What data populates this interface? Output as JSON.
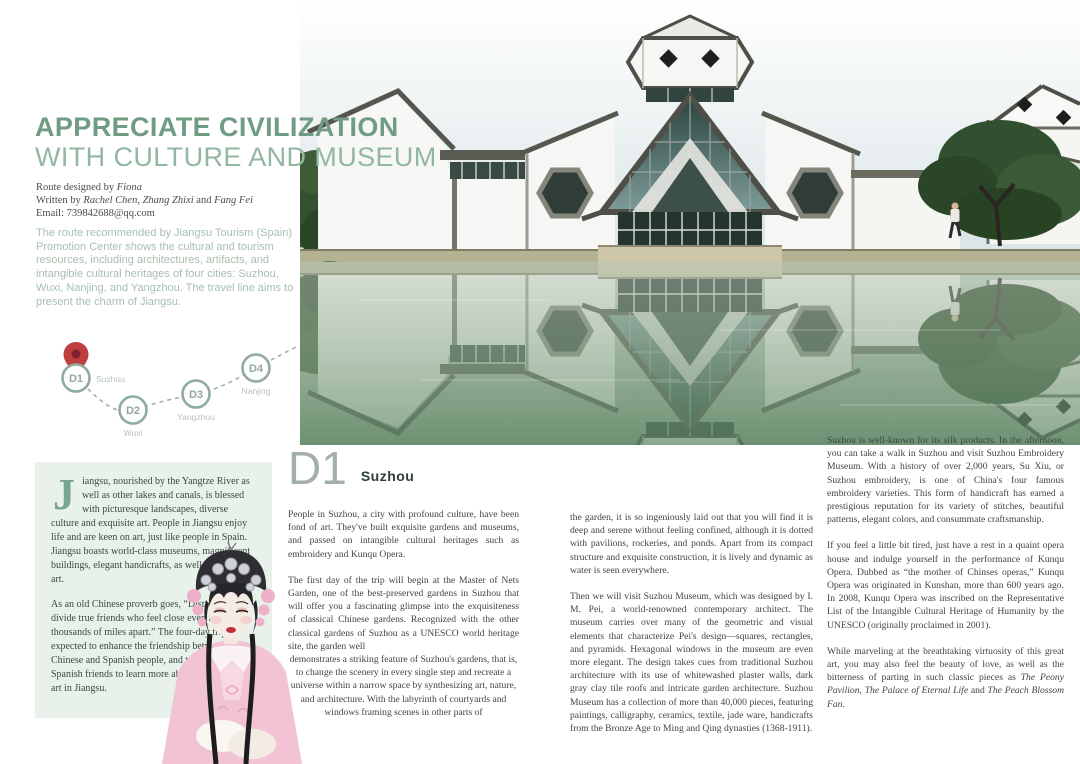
{
  "header": {
    "title_line1": "APPRECIATE CIVILIZATION",
    "title_line2": "WITH CULTURE AND MUSEUM",
    "credits": [
      {
        "pre": "Route designed by ",
        "name1": "Fiona",
        "mid": "",
        "name2": ""
      },
      {
        "pre": "Written by ",
        "name1": "Rachel Chen, Zhang Zhixi",
        "mid": " and ",
        "name2": "Fang Fei"
      },
      {
        "pre": "Email: 739842688@qq.com",
        "name1": "",
        "mid": "",
        "name2": ""
      }
    ]
  },
  "intro": {
    "text": "The route recommended by Jiangsu Tourism (Spain) Promotion Center shows the cultural and tourism resources, including architectures, artifacts, and intangible cultural heritages of four cities: Suzhou, Wuxi, Nanjing, and Yangzhou. The travel line aims to present the charm of Jiangsu."
  },
  "route_map": {
    "stops": [
      {
        "id": "D1",
        "city": "Suzhou"
      },
      {
        "id": "D2",
        "city": "Wuxi"
      },
      {
        "id": "D3",
        "city": "Yangzhou"
      },
      {
        "id": "D4",
        "city": "Nanjing"
      }
    ],
    "pin_icon": "red-location-pin",
    "accent_color": "#8fac9c",
    "pin_color": "#bf3e3e"
  },
  "sidebar_box": {
    "dropcap": "J",
    "p1_rest": "iangsu, nourished by the Yangtze River as well as other lakes and canals, is blessed with picturesque landscapes, diverse culture and exquisite art. People in Jiangsu enjoy life and are keen on art, just like people in Spain. Jiangsu boasts world-class museums, magnificent buildings, elegant handicrafts, as well as ingenious art.",
    "p2": "As an old Chinese proverb goes, “Distance cannot divide true friends who feel close even if they are thousands of miles apart.” The four-day trip is expected to enhance the friendship between the Chinese and Spanish people, and to help our Spanish friends to learn more about the culture and art in Jiangsu."
  },
  "day_section": {
    "day": "D1",
    "city": "Suzhou"
  },
  "columns": {
    "col1": {
      "p1": "People in Suzhou, a city with profound culture, have been fond of art. They've built exquisite gardens and museums, and passed on intangible cultural heritages such as embroidery and Kunqu Opera.",
      "p2a": "The first day of the trip will begin at the Master of Nets Garden, one of the best-preserved gardens in Suzhou that will offer you a fascinating glimpse into the exquisiteness of classical Chinese gardens. Recognized with the other classical gardens of Suzhou as a UNESCO world heritage site, the garden well",
      "p2b": "demonstrates a striking feature of Suzhou's gardens, that is, to change the scenery in every single step and recreate a universe within a narrow space by synthesizing art, nature, and architecture. With the labyrinth of courtyards and windows framing scenes in other parts of"
    },
    "col2": {
      "p1": "the garden, it is so ingeniously laid out that you will find it is deep and serene without feeling confined, although it is dotted with pavilions, rockeries, and ponds. Apart from its compact structure and exquisite construction, it is lively and dynamic as water is seen everywhere.",
      "p2": "Then we will visit Suzhou Museum, which was designed by I. M. Pei, a world-renowned contemporary architect. The museum carries over many of the geometric and visual elements that characterize Pei's design—squares, rectangles, and pyramids. Hexagonal windows in the museum are even more elegant. The design takes cues from traditional Suzhou architecture with its use of whitewashed plaster walls, dark gray clay tile roofs and intricate garden architecture. Suzhou Museum has a collection of more than 40,000 pieces, featuring paintings, calligraphy, ceramics, textile, jade ware, handicrafts from the Bronze Age to Ming and Qing dynasties (1368-1911)."
    },
    "col3": {
      "p1": "Suzhou is well-known for its silk products. In the afternoon, you can take a walk in Suzhou and visit Suzhou Embroidery Museum. With a history of over 2,000 years, Su Xiu, or Suzhou embroidery, is one of China's four famous embroidery varieties. This form of handicraft has earned a prestigious reputation for its variety of stitches, beautiful patterns, elegant colors, and consummate craftsmanship.",
      "p2": "If you feel a little bit tired, just have a rest in a quaint opera house and indulge yourself in the performance of Kunqu Opera. Dubbed as “the mother of Chinses operas,” Kunqu Opera was originated in Kunshan, more than 600 years ago. In 2008, Kunqu Opera was inscribed on the Representative List of the Intangible Cultural Heritage of Humanity by the UNESCO (originally proclaimed in 2001).",
      "p3_pre": "While marveling at the breathtaking virtuosity of this great art, you may also feel the beauty of love, as well as the bitterness of parting in such classic pieces as ",
      "p3_i1": "The Peony Pavilion",
      "p3_s1": ", ",
      "p3_i2": "The Palace of Eternal Life",
      "p3_s2": " and ",
      "p3_i3": "The Peach Blossom Fan",
      "p3_end": "."
    }
  },
  "illustrations": {
    "photo_icon": "suzhou-museum-photo",
    "performer_icon": "kunqu-opera-performer-photo"
  },
  "colors": {
    "title_bold": "#6f9c83",
    "title_light": "#92b7a0",
    "intro_text": "#a6bfae",
    "mint_box_bg": "#e8f1ea",
    "body_text": "#3e4541"
  }
}
